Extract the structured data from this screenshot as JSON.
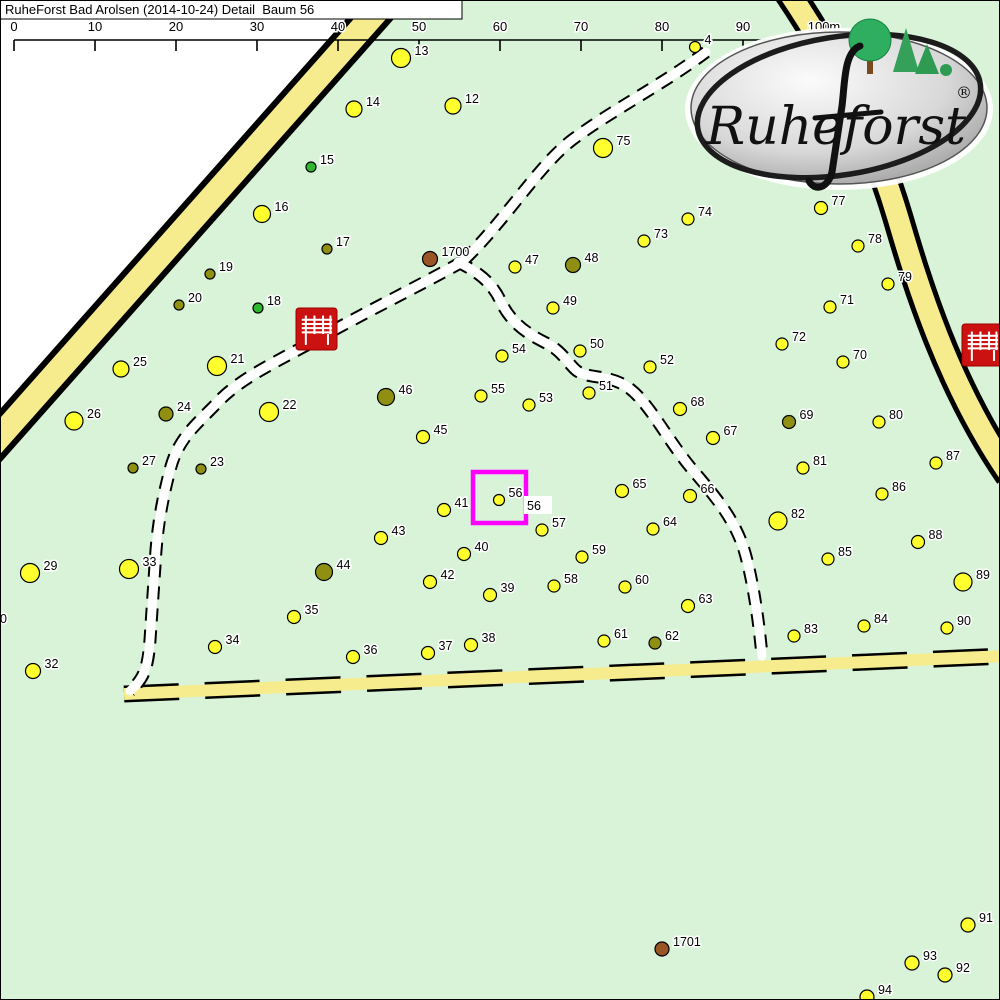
{
  "title": {
    "text": "RuheForst Bad Arolsen (2014-10-24) Detail  Baum 56"
  },
  "colors": {
    "map_green": "#d9f3d9",
    "outside_white": "#ffffff",
    "road_yellow": "#f6ec8e",
    "road_black": "#000000",
    "trail_white": "#ffffff",
    "highlight_magenta": "#ff00ff",
    "bench_red": "#cc1111",
    "tree_yellow": "#ffff2e",
    "tree_olive": "#8f8f12",
    "tree_green": "#2eb82e",
    "tree_brown": "#9a5526",
    "label_fill": "#000000",
    "label_halo": "#ffffff",
    "border": "#000000"
  },
  "scalebar": {
    "line_y": 40,
    "tick_bottom": 51,
    "label_baseline": 31,
    "ticks": [
      {
        "x": 14,
        "label": "0"
      },
      {
        "x": 95,
        "label": "10"
      },
      {
        "x": 176,
        "label": "20"
      },
      {
        "x": 257,
        "label": "30"
      },
      {
        "x": 338,
        "label": "40"
      },
      {
        "x": 419,
        "label": "50"
      },
      {
        "x": 500,
        "label": "60"
      },
      {
        "x": 581,
        "label": "70"
      },
      {
        "x": 662,
        "label": "80"
      },
      {
        "x": 743,
        "label": "90"
      },
      {
        "x": 824,
        "label": "100m"
      }
    ]
  },
  "outside_polygon": "0,0 366,0 -10,425",
  "roads": [
    {
      "name": "road-northwest",
      "style": "solid",
      "d": "M 392,-6 L -14,452",
      "outer_w": 36,
      "inner_w": 24
    },
    {
      "name": "road-east",
      "style": "solid",
      "d": "M 786,-12 C 845,75 878,150 898,218 C 917,283 948,385 1010,475",
      "outer_w": 31,
      "inner_w": 21
    },
    {
      "name": "road-south",
      "style": "dashed",
      "d": "M 124,694 L 1006,656",
      "outer_w": 17,
      "inner_w": 12,
      "dash": "55 26"
    }
  ],
  "trails": [
    {
      "name": "trail-north",
      "d": "M 706,52 C 662,85 612,110 572,140 C 538,166 506,220 462,262"
    },
    {
      "name": "trail-west",
      "d": "M 462,262 C 415,288 360,315 316,340 C 280,360 240,378 218,402 C 196,425 178,438 170,470 C 162,500 158,525 156,550 L 150,640 C 148,666 145,678 130,691"
    },
    {
      "name": "trail-southeast",
      "d": "M 458,262 C 478,272 492,282 501,302 C 509,318 520,330 544,342 C 562,350 568,364 577,371 C 589,379 606,374 626,386 C 648,400 666,438 691,468 C 716,497 736,521 745,553 C 753,581 759,622 762,656"
    }
  ],
  "benches": [
    {
      "x": 296,
      "y": 308,
      "w": 41,
      "h": 42
    },
    {
      "x": 962,
      "y": 324,
      "w": 41,
      "h": 42
    }
  ],
  "highlight": {
    "x": 473,
    "y": 472,
    "w": 53,
    "h": 51,
    "stroke_w": 4.5,
    "tree": "56"
  },
  "logo": {
    "x": 688,
    "y": 26,
    "w": 302,
    "h": 162,
    "text": "Ruheforst",
    "reg": "®"
  },
  "trees": [
    {
      "n": "4",
      "x": 695,
      "y": 47,
      "r": 5.5,
      "c": "y"
    },
    {
      "n": "12",
      "x": 453,
      "y": 106,
      "r": 8,
      "c": "y"
    },
    {
      "n": "13",
      "x": 401,
      "y": 58,
      "r": 9.5,
      "c": "y"
    },
    {
      "n": "14",
      "x": 354,
      "y": 109,
      "r": 8,
      "c": "y"
    },
    {
      "n": "15",
      "x": 311,
      "y": 167,
      "r": 5,
      "c": "g"
    },
    {
      "n": "16",
      "x": 262,
      "y": 214,
      "r": 8.5,
      "c": "y"
    },
    {
      "n": "17",
      "x": 327,
      "y": 249,
      "r": 5,
      "c": "o"
    },
    {
      "n": "18",
      "x": 258,
      "y": 308,
      "r": 5,
      "c": "g"
    },
    {
      "n": "19",
      "x": 210,
      "y": 274,
      "r": 5,
      "c": "o"
    },
    {
      "n": "20",
      "x": 179,
      "y": 305,
      "r": 5,
      "c": "o"
    },
    {
      "n": "21",
      "x": 217,
      "y": 366,
      "r": 9.5,
      "c": "y"
    },
    {
      "n": "22",
      "x": 269,
      "y": 412,
      "r": 9.5,
      "c": "y"
    },
    {
      "n": "23",
      "x": 201,
      "y": 469,
      "r": 5,
      "c": "o"
    },
    {
      "n": "24",
      "x": 166,
      "y": 414,
      "r": 7,
      "c": "o"
    },
    {
      "n": "25",
      "x": 121,
      "y": 369,
      "r": 8,
      "c": "y"
    },
    {
      "n": "26",
      "x": 74,
      "y": 421,
      "r": 9,
      "c": "y"
    },
    {
      "n": "27",
      "x": 133,
      "y": 468,
      "r": 5,
      "c": "o"
    },
    {
      "n": "29",
      "x": 30,
      "y": 573,
      "r": 9.5,
      "c": "y"
    },
    {
      "n": "32",
      "x": 33,
      "y": 671,
      "r": 7.5,
      "c": "y"
    },
    {
      "n": "33",
      "x": 129,
      "y": 569,
      "r": 9.5,
      "c": "y"
    },
    {
      "n": "34",
      "x": 215,
      "y": 647,
      "r": 6.5,
      "c": "y"
    },
    {
      "n": "35",
      "x": 294,
      "y": 617,
      "r": 6.5,
      "c": "y"
    },
    {
      "n": "36",
      "x": 353,
      "y": 657,
      "r": 6.5,
      "c": "y"
    },
    {
      "n": "37",
      "x": 428,
      "y": 653,
      "r": 6.5,
      "c": "y"
    },
    {
      "n": "38",
      "x": 471,
      "y": 645,
      "r": 6.5,
      "c": "y"
    },
    {
      "n": "39",
      "x": 490,
      "y": 595,
      "r": 6.5,
      "c": "y"
    },
    {
      "n": "40",
      "x": 464,
      "y": 554,
      "r": 6.5,
      "c": "y"
    },
    {
      "n": "41",
      "x": 444,
      "y": 510,
      "r": 6.5,
      "c": "y"
    },
    {
      "n": "42",
      "x": 430,
      "y": 582,
      "r": 6.5,
      "c": "y"
    },
    {
      "n": "43",
      "x": 381,
      "y": 538,
      "r": 6.5,
      "c": "y"
    },
    {
      "n": "44",
      "x": 324,
      "y": 572,
      "r": 8.5,
      "c": "o"
    },
    {
      "n": "45",
      "x": 423,
      "y": 437,
      "r": 6.5,
      "c": "y"
    },
    {
      "n": "46",
      "x": 386,
      "y": 397,
      "r": 8.5,
      "c": "o"
    },
    {
      "n": "47",
      "x": 515,
      "y": 267,
      "r": 6,
      "c": "y"
    },
    {
      "n": "48",
      "x": 573,
      "y": 265,
      "r": 7.5,
      "c": "o"
    },
    {
      "n": "49",
      "x": 553,
      "y": 308,
      "r": 6,
      "c": "y"
    },
    {
      "n": "50",
      "x": 580,
      "y": 351,
      "r": 6,
      "c": "y"
    },
    {
      "n": "51",
      "x": 589,
      "y": 393,
      "r": 6,
      "c": "y"
    },
    {
      "n": "52",
      "x": 650,
      "y": 367,
      "r": 6,
      "c": "y"
    },
    {
      "n": "53",
      "x": 529,
      "y": 405,
      "r": 6,
      "c": "y"
    },
    {
      "n": "54",
      "x": 502,
      "y": 356,
      "r": 6,
      "c": "y"
    },
    {
      "n": "55",
      "x": 481,
      "y": 396,
      "r": 6,
      "c": "y"
    },
    {
      "n": "56",
      "x": 499,
      "y": 500,
      "r": 5.5,
      "c": "y"
    },
    {
      "n": "57",
      "x": 542,
      "y": 530,
      "r": 6,
      "c": "y"
    },
    {
      "n": "58",
      "x": 554,
      "y": 586,
      "r": 6,
      "c": "y"
    },
    {
      "n": "59",
      "x": 582,
      "y": 557,
      "r": 6,
      "c": "y"
    },
    {
      "n": "60",
      "x": 625,
      "y": 587,
      "r": 6,
      "c": "y"
    },
    {
      "n": "61",
      "x": 604,
      "y": 641,
      "r": 6,
      "c": "y"
    },
    {
      "n": "62",
      "x": 655,
      "y": 643,
      "r": 6,
      "c": "o"
    },
    {
      "n": "63",
      "x": 688,
      "y": 606,
      "r": 6.5,
      "c": "y"
    },
    {
      "n": "64",
      "x": 653,
      "y": 529,
      "r": 6,
      "c": "y"
    },
    {
      "n": "65",
      "x": 622,
      "y": 491,
      "r": 6.5,
      "c": "y"
    },
    {
      "n": "66",
      "x": 690,
      "y": 496,
      "r": 6.5,
      "c": "y"
    },
    {
      "n": "67",
      "x": 713,
      "y": 438,
      "r": 6.5,
      "c": "y"
    },
    {
      "n": "68",
      "x": 680,
      "y": 409,
      "r": 6.5,
      "c": "y"
    },
    {
      "n": "69",
      "x": 789,
      "y": 422,
      "r": 6.5,
      "c": "o"
    },
    {
      "n": "70",
      "x": 843,
      "y": 362,
      "r": 6,
      "c": "y"
    },
    {
      "n": "71",
      "x": 830,
      "y": 307,
      "r": 6,
      "c": "y"
    },
    {
      "n": "72",
      "x": 782,
      "y": 344,
      "r": 6,
      "c": "y"
    },
    {
      "n": "73",
      "x": 644,
      "y": 241,
      "r": 6,
      "c": "y"
    },
    {
      "n": "74",
      "x": 688,
      "y": 219,
      "r": 6,
      "c": "y"
    },
    {
      "n": "75",
      "x": 603,
      "y": 148,
      "r": 9.5,
      "c": "y"
    },
    {
      "n": "77",
      "x": 821,
      "y": 208,
      "r": 6.5,
      "c": "y"
    },
    {
      "n": "78",
      "x": 858,
      "y": 246,
      "r": 6,
      "c": "y"
    },
    {
      "n": "79",
      "x": 888,
      "y": 284,
      "r": 6,
      "c": "y"
    },
    {
      "n": "80",
      "x": 879,
      "y": 422,
      "r": 6,
      "c": "y"
    },
    {
      "n": "81",
      "x": 803,
      "y": 468,
      "r": 6,
      "c": "y"
    },
    {
      "n": "82",
      "x": 778,
      "y": 521,
      "r": 9,
      "c": "y"
    },
    {
      "n": "83",
      "x": 794,
      "y": 636,
      "r": 6,
      "c": "y"
    },
    {
      "n": "84",
      "x": 864,
      "y": 626,
      "r": 6,
      "c": "y"
    },
    {
      "n": "85",
      "x": 828,
      "y": 559,
      "r": 6,
      "c": "y"
    },
    {
      "n": "86",
      "x": 882,
      "y": 494,
      "r": 6,
      "c": "y"
    },
    {
      "n": "87",
      "x": 936,
      "y": 463,
      "r": 6,
      "c": "y"
    },
    {
      "n": "88",
      "x": 918,
      "y": 542,
      "r": 6.5,
      "c": "y"
    },
    {
      "n": "89",
      "x": 963,
      "y": 582,
      "r": 9,
      "c": "y"
    },
    {
      "n": "90",
      "x": 947,
      "y": 628,
      "r": 6,
      "c": "y"
    },
    {
      "n": "91",
      "x": 968,
      "y": 925,
      "r": 7,
      "c": "y"
    },
    {
      "n": "92",
      "x": 945,
      "y": 975,
      "r": 7,
      "c": "y"
    },
    {
      "n": "93",
      "x": 912,
      "y": 963,
      "r": 7,
      "c": "y"
    },
    {
      "n": "94",
      "x": 867,
      "y": 997,
      "r": 7,
      "c": "y"
    },
    {
      "n": "1700",
      "x": 430,
      "y": 259,
      "r": 7.5,
      "c": "b"
    },
    {
      "n": "1701",
      "x": 662,
      "y": 949,
      "r": 7,
      "c": "b"
    }
  ],
  "extra_labels": [
    {
      "text": "56",
      "x": 527,
      "y": 510,
      "boxed": true
    },
    {
      "text": "30",
      "x": -7,
      "y": 623,
      "boxed": false
    },
    {
      "text": "28",
      "x": -15,
      "y": 523,
      "boxed": false
    }
  ]
}
